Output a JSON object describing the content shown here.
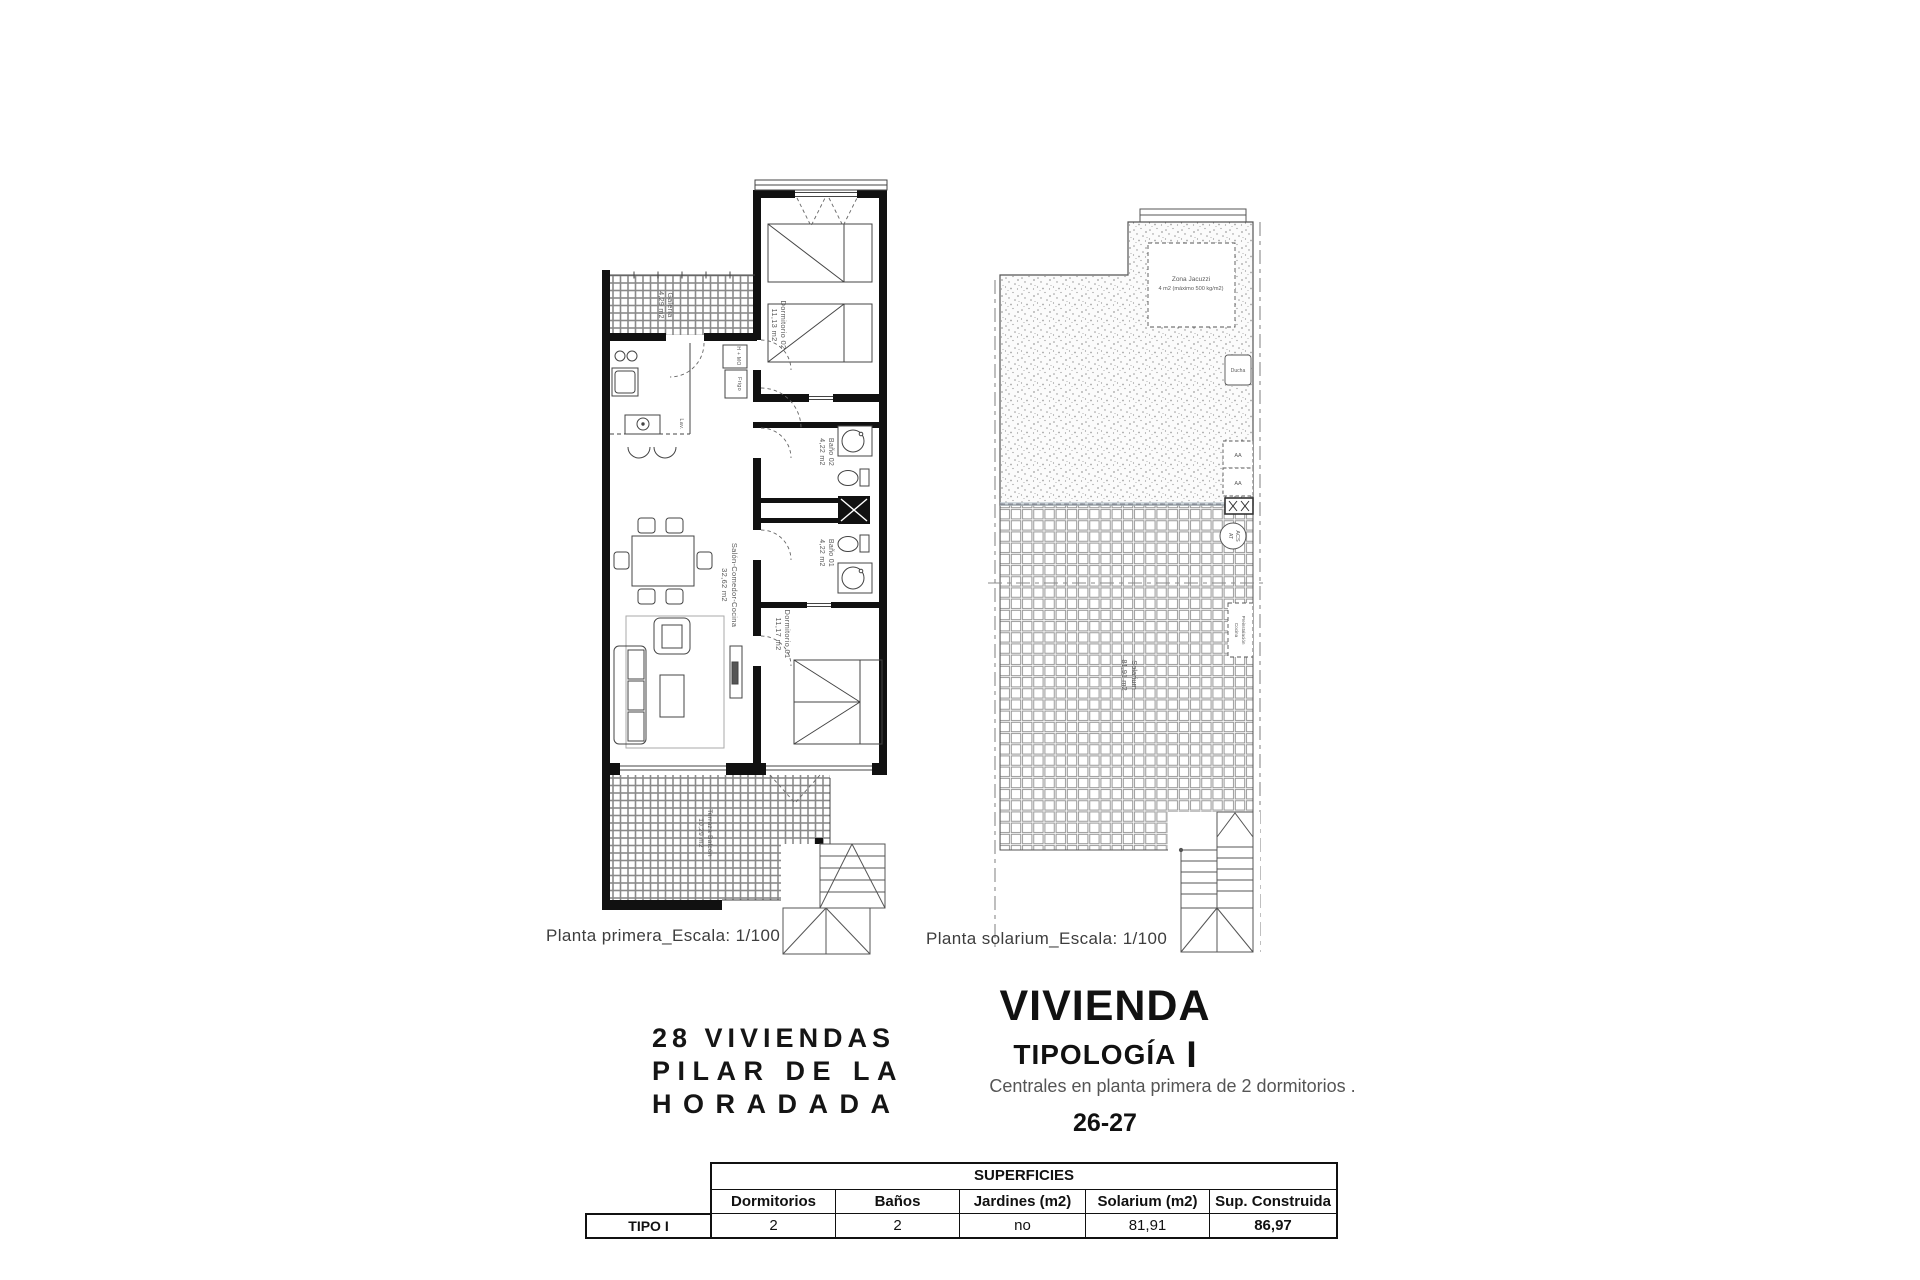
{
  "plan1": {
    "caption": "Planta primera_Escala: 1/100",
    "rooms": {
      "galeria": {
        "name": "Galería",
        "area": "4,29 m2"
      },
      "dormitorio02": {
        "name": "Dormitorio 02",
        "area": "11,13 m2"
      },
      "bano02": {
        "name": "Baño 02",
        "area": "4,22 m2"
      },
      "salon": {
        "name": "Salón-Comedor-Cocina",
        "area": "32,62 m2"
      },
      "bano01": {
        "name": "Baño 01",
        "area": "4,22 m2"
      },
      "dormitorio01": {
        "name": "Dormitorio 01",
        "area": "11,17 m2"
      },
      "terraza": {
        "name": "Terraza Balcón",
        "area": "10,29 m2"
      }
    },
    "kitchen": {
      "oven": "H + MO",
      "fridge": "Frigo",
      "washer": "Lav."
    }
  },
  "plan2": {
    "caption": "Planta solarium_Escala: 1/100",
    "labels": {
      "jacuzzi_name": "Zona Jacuzzi",
      "jacuzzi_spec": "4 m2 (máximo 500 kg/m2)",
      "ducha": "Ducha",
      "aa1": "AA",
      "aa2": "AA",
      "acs": "ACS",
      "acs2": "AT",
      "preinst1": "Preinstalación",
      "preinst2": "Cocina",
      "solarium_name": "Solarium",
      "solarium_area": "81,91 m2"
    }
  },
  "project": {
    "line1": "28 VIVIENDAS",
    "line2": "PILAR DE LA",
    "line3": "HORADADA"
  },
  "vivienda": {
    "title": "VIVIENDA",
    "subtitle": "TIPOLOGÍA",
    "type_mark": "I",
    "desc": "Centrales en planta primera de 2 dormitorios .",
    "units": "26-27"
  },
  "table": {
    "title": "SUPERFICIES",
    "row_label": "TIPO I",
    "headers": [
      "Dormitorios",
      "Baños",
      "Jardines (m2)",
      "Solarium (m2)",
      "Sup. Construida"
    ],
    "values": [
      "2",
      "2",
      "no",
      "81,91",
      "86,97"
    ]
  },
  "colors": {
    "wall": "#111111",
    "line": "#444444",
    "hatch": "#8a8a8a",
    "accent_strip": "#b9c4cc"
  }
}
